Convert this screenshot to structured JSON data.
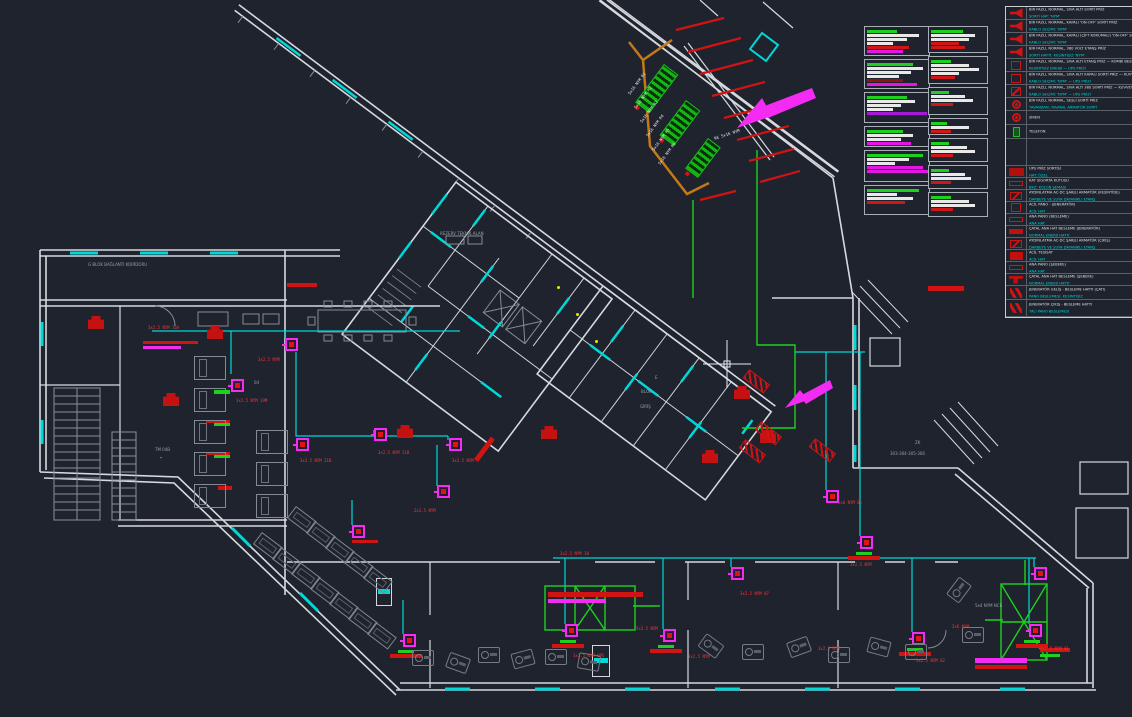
{
  "colors": {
    "background": "#1e232e",
    "wall": "#d6dade",
    "cyan": "#00d8d8",
    "green": "#1fd11f",
    "red": "#d01414",
    "magenta": "#f32bf3",
    "violet": "#a818d8",
    "orange": "#c27a18",
    "yellow": "#e8e800",
    "gray_furniture": "#80868f",
    "dim_text": "#99a0a9",
    "legend_cyan": "#00d8d8"
  },
  "labels": {
    "gray": [
      {
        "x": 88,
        "y": 262,
        "t": "G BLOK BAĞLANTI KORİDORU",
        "s": 8
      },
      {
        "x": 440,
        "y": 232,
        "t": "REZERV TEKNİK ALAN",
        "s": 5
      },
      {
        "x": 655,
        "y": 372,
        "t": "E",
        "s": 11
      },
      {
        "x": 641,
        "y": 386,
        "t": "BLOK",
        "s": 11
      },
      {
        "x": 640,
        "y": 401,
        "t": "GİRİŞ",
        "s": 11
      },
      {
        "x": 915,
        "y": 440,
        "t": "ZK",
        "s": 9
      },
      {
        "x": 890,
        "y": 451,
        "t": "303-304-305-306",
        "s": 9
      },
      {
        "x": 155,
        "y": 448,
        "t": "TM 04B",
        "s": 6
      },
      {
        "x": 160,
        "y": 456,
        "t": "←",
        "s": 7
      },
      {
        "x": 254,
        "y": 380,
        "t": "04",
        "s": 8
      },
      {
        "x": 975,
        "y": 604,
        "t": "5x4 NYM NCK",
        "s": 4
      }
    ],
    "circuit": [
      {
        "x": 148,
        "y": 317,
        "t": "3x2.5 NYM 16A"
      },
      {
        "x": 258,
        "y": 349,
        "t": "3x2.5 NYM"
      },
      {
        "x": 236,
        "y": 390,
        "t": "3x2.5 NYM 19M"
      },
      {
        "x": 300,
        "y": 450,
        "t": "3x2.5 NYM 21B"
      },
      {
        "x": 378,
        "y": 442,
        "t": "3x2.5 NYM 21B"
      },
      {
        "x": 452,
        "y": 450,
        "t": "3x2.5 NYM"
      },
      {
        "x": 414,
        "y": 500,
        "t": "2x2.5 NYM"
      },
      {
        "x": 560,
        "y": 543,
        "t": "3x2.5 NYM 18"
      },
      {
        "x": 573,
        "y": 645,
        "t": "3x2.5 NYM UPS"
      },
      {
        "x": 636,
        "y": 618,
        "t": "5x2.5 NYM"
      },
      {
        "x": 688,
        "y": 646,
        "t": "3x2.5 NYM"
      },
      {
        "x": 740,
        "y": 583,
        "t": "3x2.5 NYM 07"
      },
      {
        "x": 838,
        "y": 492,
        "t": "5x6 NYM 05"
      },
      {
        "x": 850,
        "y": 554,
        "t": "3x2.5 NYM"
      },
      {
        "x": 916,
        "y": 650,
        "t": "3x2.5 NYM 02"
      },
      {
        "x": 1040,
        "y": 638,
        "t": "3x2.5 NYM 01"
      },
      {
        "x": 952,
        "y": 616,
        "t": "2x6 NYM"
      },
      {
        "x": 818,
        "y": 638,
        "t": "3x2.5 NYM"
      }
    ],
    "risers": [
      {
        "x": 628,
        "y": 84,
        "t": "5x16 NYM R1",
        "rot": -53
      },
      {
        "x": 634,
        "y": 98,
        "t": "5x16 NYM R2",
        "rot": -53
      },
      {
        "x": 640,
        "y": 112,
        "t": "5x16 NYM R3",
        "rot": -53
      },
      {
        "x": 646,
        "y": 126,
        "t": "5x16 NYM R4",
        "rot": -53
      },
      {
        "x": 652,
        "y": 140,
        "t": "5x16 NYM R5",
        "rot": -53
      },
      {
        "x": 658,
        "y": 154,
        "t": "5x16 NYM R6",
        "rot": -53
      },
      {
        "x": 714,
        "y": 128,
        "t": "RE 5x16 NYM",
        "rot": -18
      }
    ]
  },
  "devices": {
    "sockets": [
      {
        "x": 285,
        "y": 338
      },
      {
        "x": 231,
        "y": 379
      },
      {
        "x": 296,
        "y": 438
      },
      {
        "x": 374,
        "y": 428
      },
      {
        "x": 449,
        "y": 438
      },
      {
        "x": 437,
        "y": 485
      },
      {
        "x": 352,
        "y": 525
      },
      {
        "x": 403,
        "y": 634
      },
      {
        "x": 565,
        "y": 624
      },
      {
        "x": 663,
        "y": 629
      },
      {
        "x": 731,
        "y": 567
      },
      {
        "x": 826,
        "y": 490
      },
      {
        "x": 860,
        "y": 536
      },
      {
        "x": 912,
        "y": 632
      },
      {
        "x": 1029,
        "y": 624
      },
      {
        "x": 1034,
        "y": 567
      }
    ],
    "bases": [
      {
        "x": 552,
        "y": 640
      },
      {
        "x": 650,
        "y": 645
      },
      {
        "x": 899,
        "y": 648
      },
      {
        "x": 1016,
        "y": 640
      },
      {
        "x": 390,
        "y": 650
      },
      {
        "x": 848,
        "y": 552
      }
    ],
    "cabinets": [
      {
        "x": 88,
        "y": 316
      },
      {
        "x": 207,
        "y": 326
      },
      {
        "x": 163,
        "y": 393
      },
      {
        "x": 397,
        "y": 425
      },
      {
        "x": 541,
        "y": 426
      },
      {
        "x": 734,
        "y": 386
      },
      {
        "x": 702,
        "y": 450
      },
      {
        "x": 760,
        "y": 430
      }
    ],
    "dampers": [
      {
        "x": 746,
        "y": 368,
        "rot": 37
      },
      {
        "x": 758,
        "y": 420,
        "rot": 37
      },
      {
        "x": 812,
        "y": 437,
        "rot": 37
      },
      {
        "x": 742,
        "y": 438,
        "rot": 37
      }
    ],
    "ghatch": [
      {
        "x": 664,
        "y": 64,
        "w": 16,
        "h": 46,
        "rot": 37
      },
      {
        "x": 686,
        "y": 100,
        "w": 16,
        "h": 42,
        "rot": 37
      },
      {
        "x": 708,
        "y": 138,
        "w": 14,
        "h": 36,
        "rot": 37
      }
    ],
    "strips": [
      {
        "x": 143,
        "y": 341,
        "w": 55,
        "h": 3,
        "bg": "#d01414"
      },
      {
        "x": 143,
        "y": 346,
        "w": 38,
        "h": 3,
        "bg": "#f32bf3"
      },
      {
        "x": 548,
        "y": 592,
        "w": 95,
        "h": 5,
        "bg": "#d01414"
      },
      {
        "x": 548,
        "y": 599,
        "w": 58,
        "h": 4,
        "bg": "#f32bf3"
      },
      {
        "x": 928,
        "y": 286,
        "w": 36,
        "h": 5,
        "bg": "#d01414"
      },
      {
        "x": 975,
        "y": 658,
        "w": 52,
        "h": 5,
        "bg": "#f32bf3"
      },
      {
        "x": 975,
        "y": 665,
        "w": 52,
        "h": 4,
        "bg": "#d01414"
      },
      {
        "x": 287,
        "y": 283,
        "w": 30,
        "h": 4,
        "bg": "#d01414"
      },
      {
        "x": 476,
        "y": 458,
        "w": 28,
        "h": 5,
        "bg": "#d01414",
        "rot": -53
      },
      {
        "x": 1040,
        "y": 648,
        "w": 30,
        "h": 4,
        "bg": "#d01414"
      },
      {
        "x": 1040,
        "y": 654,
        "w": 20,
        "h": 3,
        "bg": "#1fd11f"
      },
      {
        "x": 352,
        "y": 540,
        "w": 26,
        "h": 3,
        "bg": "#d01414"
      },
      {
        "x": 214,
        "y": 390,
        "w": 16,
        "h": 4,
        "bg": "#1fd11f"
      },
      {
        "x": 214,
        "y": 422,
        "w": 16,
        "h": 4,
        "bg": "#1fd11f"
      },
      {
        "x": 214,
        "y": 454,
        "w": 16,
        "h": 4,
        "bg": "#1fd11f"
      },
      {
        "x": 218,
        "y": 486,
        "w": 14,
        "h": 4,
        "bg": "#d01414"
      },
      {
        "x": 206,
        "y": 420,
        "w": 24,
        "h": 3,
        "bg": "#d01414"
      },
      {
        "x": 206,
        "y": 452,
        "w": 24,
        "h": 3,
        "bg": "#d01414"
      }
    ],
    "ydots": [
      {
        "x": 557,
        "y": 286
      },
      {
        "x": 576,
        "y": 313
      },
      {
        "x": 595,
        "y": 340
      }
    ],
    "doors": [
      {
        "x": 376,
        "y": 578,
        "w": 14,
        "h": 26
      },
      {
        "x": 592,
        "y": 645,
        "w": 16,
        "h": 30
      }
    ],
    "desks": [
      {
        "x": 296,
        "y": 506,
        "rot": 37
      },
      {
        "x": 315,
        "y": 521,
        "rot": 37
      },
      {
        "x": 334,
        "y": 536,
        "rot": 37
      },
      {
        "x": 353,
        "y": 551,
        "rot": 37
      },
      {
        "x": 372,
        "y": 566,
        "rot": 37
      },
      {
        "x": 262,
        "y": 532,
        "rot": 37
      },
      {
        "x": 281,
        "y": 547,
        "rot": 37
      },
      {
        "x": 300,
        "y": 562,
        "rot": 37
      },
      {
        "x": 319,
        "y": 577,
        "rot": 37
      },
      {
        "x": 338,
        "y": 592,
        "rot": 37
      },
      {
        "x": 357,
        "y": 607,
        "rot": 37
      },
      {
        "x": 376,
        "y": 622,
        "rot": 37
      }
    ],
    "beds": [
      {
        "x": 194,
        "y": 356
      },
      {
        "x": 194,
        "y": 388
      },
      {
        "x": 194,
        "y": 420
      },
      {
        "x": 194,
        "y": 452
      },
      {
        "x": 194,
        "y": 484
      },
      {
        "x": 256,
        "y": 430
      },
      {
        "x": 256,
        "y": 462
      },
      {
        "x": 256,
        "y": 494
      }
    ],
    "gyms": [
      {
        "x": 412,
        "y": 650
      },
      {
        "x": 447,
        "y": 655,
        "rot": 20
      },
      {
        "x": 478,
        "y": 647
      },
      {
        "x": 512,
        "y": 651,
        "rot": -15
      },
      {
        "x": 545,
        "y": 649
      },
      {
        "x": 578,
        "y": 654,
        "rot": 10
      },
      {
        "x": 700,
        "y": 638,
        "rot": 36
      },
      {
        "x": 742,
        "y": 644
      },
      {
        "x": 788,
        "y": 639,
        "rot": -20
      },
      {
        "x": 828,
        "y": 647
      },
      {
        "x": 868,
        "y": 639,
        "rot": 15
      },
      {
        "x": 905,
        "y": 644
      },
      {
        "x": 948,
        "y": 582,
        "rot": -53
      },
      {
        "x": 962,
        "y": 627
      }
    ]
  },
  "schedules": {
    "boxes": [
      {
        "x": 864,
        "y": 26,
        "w": 66,
        "h": 30,
        "bars": [
          {
            "bg": "#1fd11f",
            "w": 30
          },
          {
            "bg": "#e8e8e8",
            "w": 52
          },
          {
            "bg": "#e8e8e8",
            "w": 40
          },
          {
            "bg": "#e8e8e8",
            "w": 26
          },
          {
            "bg": "#cf1717",
            "w": 42
          },
          {
            "bg": "#e515e5",
            "w": 36
          }
        ]
      },
      {
        "x": 864,
        "y": 59,
        "w": 66,
        "h": 30,
        "bars": [
          {
            "bg": "#1fd11f",
            "w": 46
          },
          {
            "bg": "#e8e8e8",
            "w": 56
          },
          {
            "bg": "#e8e8e8",
            "w": 44
          },
          {
            "bg": "#e8e8e8",
            "w": 32
          },
          {
            "bg": "#8c1515",
            "w": 36
          },
          {
            "bg": "#e515e5",
            "w": 50
          }
        ]
      },
      {
        "x": 864,
        "y": 92,
        "w": 66,
        "h": 31,
        "bars": [
          {
            "bg": "#1fd11f",
            "w": 40
          },
          {
            "bg": "#e8e8e8",
            "w": 48
          },
          {
            "bg": "#e8e8e8",
            "w": 34
          },
          {
            "bg": "#e8e8e8",
            "w": 26
          },
          {
            "bg": "#a818d8",
            "w": 60
          }
        ]
      },
      {
        "x": 864,
        "y": 126,
        "w": 66,
        "h": 21,
        "bars": [
          {
            "bg": "#1fd11f",
            "w": 36
          },
          {
            "bg": "#e8e8e8",
            "w": 46
          },
          {
            "bg": "#e8e8e8",
            "w": 34
          },
          {
            "bg": "#e515e5",
            "w": 44
          }
        ]
      },
      {
        "x": 864,
        "y": 150,
        "w": 66,
        "h": 32,
        "bars": [
          {
            "bg": "#1fd11f",
            "w": 56
          },
          {
            "bg": "#e8e8e8",
            "w": 42
          },
          {
            "bg": "#e8e8e8",
            "w": 28
          },
          {
            "bg": "#e515e5",
            "w": 56
          },
          {
            "bg": "#e515e5",
            "w": 62
          }
        ]
      },
      {
        "x": 864,
        "y": 185,
        "w": 66,
        "h": 30,
        "bars": [
          {
            "bg": "#1fd11f",
            "w": 52
          },
          {
            "bg": "#e8e8e8",
            "w": 30
          },
          {
            "bg": "#e8e8e8",
            "w": 46
          },
          {
            "bg": "#cf1717",
            "w": 38
          }
        ]
      },
      {
        "x": 928,
        "y": 26,
        "w": 60,
        "h": 27,
        "bars": [
          {
            "bg": "#1fd11f",
            "w": 32
          },
          {
            "bg": "#e8e8e8",
            "w": 44
          },
          {
            "bg": "#e8e8e8",
            "w": 38
          },
          {
            "bg": "#cf1717",
            "w": 28
          },
          {
            "bg": "#cf1717",
            "w": 34
          }
        ]
      },
      {
        "x": 928,
        "y": 56,
        "w": 60,
        "h": 28,
        "bars": [
          {
            "bg": "#1fd11f",
            "w": 20
          },
          {
            "bg": "#e8e8e8",
            "w": 38
          },
          {
            "bg": "#e8e8e8",
            "w": 48
          },
          {
            "bg": "#e8e8e8",
            "w": 28
          },
          {
            "bg": "#cf1717",
            "w": 24
          }
        ]
      },
      {
        "x": 928,
        "y": 87,
        "w": 60,
        "h": 28,
        "bars": [
          {
            "bg": "#1fd11f",
            "w": 18
          },
          {
            "bg": "#e8e8e8",
            "w": 34
          },
          {
            "bg": "#e8e8e8",
            "w": 42
          },
          {
            "bg": "#cf1717",
            "w": 22
          }
        ]
      },
      {
        "x": 928,
        "y": 118,
        "w": 60,
        "h": 17,
        "bars": [
          {
            "bg": "#1fd11f",
            "w": 16
          },
          {
            "bg": "#e8e8e8",
            "w": 38
          },
          {
            "bg": "#cf1717",
            "w": 20
          }
        ]
      },
      {
        "x": 928,
        "y": 138,
        "w": 60,
        "h": 24,
        "bars": [
          {
            "bg": "#1fd11f",
            "w": 18
          },
          {
            "bg": "#e8e8e8",
            "w": 36
          },
          {
            "bg": "#e8e8e8",
            "w": 44
          },
          {
            "bg": "#cf1717",
            "w": 22
          }
        ]
      },
      {
        "x": 928,
        "y": 165,
        "w": 60,
        "h": 24,
        "bars": [
          {
            "bg": "#1fd11f",
            "w": 18
          },
          {
            "bg": "#e8e8e8",
            "w": 34
          },
          {
            "bg": "#e8e8e8",
            "w": 40
          },
          {
            "bg": "#cf1717",
            "w": 20
          }
        ]
      },
      {
        "x": 928,
        "y": 192,
        "w": 60,
        "h": 25,
        "bars": [
          {
            "bg": "#1fd11f",
            "w": 20
          },
          {
            "bg": "#e8e8e8",
            "w": 38
          },
          {
            "bg": "#e8e8e8",
            "w": 44
          },
          {
            "bg": "#cf1717",
            "w": 22
          }
        ]
      }
    ]
  },
  "legend": {
    "rows": [
      {
        "h": 12,
        "icon": "ic ic-horn",
        "t1": "BİR FAZLI, NORMAL, SIVA ALTI SORTİ PRİZ",
        "t2": "SORTİ HAT: 'NYM'"
      },
      {
        "h": 12,
        "icon": "ic ic-horn",
        "t1": "BİR FAZLI, NORMAL, KAPALI 'ON-OFF' SORTİ PRİZ",
        "t2": "KABLO SEÇİMİ: 'NYM'"
      },
      {
        "h": 12,
        "icon": "ic ic-horn",
        "t1": "BİR FAZLI, NORMAL, KAPALI (ÇİFT KORUMALI) 'ON-OFF' SORTİ PRİZ",
        "t2": "KABLO SEÇİMİ: 'NYM'"
      },
      {
        "h": 12,
        "icon": "ic ic-horn",
        "t1": "BİR FAZLI, NORMAL, 380 VOLT ETANŞ PRİZ",
        "t2": "SORTİ HATTI: KESİNTİSİZ 'NYM'"
      },
      {
        "h": 12,
        "icon": "ic ic-sq",
        "t1": "BİR FAZLI, NORMAL, SIVA ALTI ETANŞ PRİZ — KOMBİ BESLEME",
        "t2": "KESİNTİSİZ ENERJİ — UPS PRİZİ"
      },
      {
        "h": 12,
        "icon": "ic ic-sq",
        "t1": "BİR FAZLI, NORMAL, SIVA ALTI KAPALI SORTİ PRİZ — KUVVET BESLEME",
        "t2": "KABLO SEÇİMİ: 'NYM' — UPS PRİZİ"
      },
      {
        "h": 12,
        "icon": "ic ic-sqg",
        "t1": "BİR FAZLI, NORMAL, SIVA ALTI 380 SORTİ PRİZ — KUVVET BESLEME",
        "t2": "KABLO SEÇİMİ: 'NYM' — UPS PRİZİ"
      },
      {
        "h": 12,
        "icon": "ic ic-ring",
        "t1": "BİR FAZLI, NORMAL, SESLİ SORTİ PRİZ",
        "t2": "TAVANDAN, TAVANA, ARMATÜR SORTİ"
      },
      {
        "h": 13,
        "icon": "ic ic-ring",
        "t1": "SİREN",
        "t2": ""
      },
      {
        "h": 13,
        "icon": "ic ic-tel",
        "t1": "TELEFON",
        "t2": ""
      },
      {
        "h": 26,
        "icon": "",
        "t1": "",
        "t2": ""
      },
      {
        "h": 11,
        "icon": "ic ic-ups",
        "t1": "UPS PRİZ SORTİSİ",
        "t2": "HAT: ÖZEL"
      },
      {
        "h": 11,
        "icon": "ic ic-bar",
        "t1": "KAT SIGORTA KUTUSU",
        "t2": "BKZ: KOLON ŞEMASI"
      },
      {
        "h": 11,
        "icon": "ic ic-diag",
        "t1": "AYDINLATMA AC-DC ŞARJLI ARMATÜR (KESİNTİDE)",
        "t2": "DARBEYE VE SUYA DAYANIKLI ETANŞ"
      },
      {
        "h": 11,
        "icon": "ic ic-sq",
        "t1": "ACİL PANO - (JENERATÖR)",
        "t2": "ACİL HAT"
      },
      {
        "h": 11,
        "icon": "ic ic-bar",
        "t1": "ANA PANO (BESLEME)",
        "t2": "ANA HAT"
      },
      {
        "h": 11,
        "icon": "ic ic-barF",
        "t1": "ÇATAL ANA HAT BESLEME (JENERATÖR)",
        "t2": "NORMAL ENERJİ HATTI"
      },
      {
        "h": 11,
        "icon": "ic ic-diag",
        "t1": "AYDINLATMA AC-DC ŞARJLI ARMATÜR (ÇIKIŞ)",
        "t2": "DARBEYE VE SUYA DAYANIKLI ETANŞ"
      },
      {
        "h": 11,
        "icon": "ic ic-fill",
        "t1": "ACİL TESİSAT",
        "t2": "ACİL HAT"
      },
      {
        "h": 11,
        "icon": "ic ic-bar",
        "t1": "ANA PANO (ŞEBEKE)",
        "t2": "ANA HAT"
      },
      {
        "h": 11,
        "icon": "ic ic-tee",
        "t1": "ÇATAL ANA HAT BESLEME (ŞEBEKE)",
        "t2": "NORMAL ENERJİ HATTI"
      },
      {
        "h": 13,
        "icon": "ic ic-hh",
        "t1": "JENERATÖR GELİŞ - BESLEME HATTI (ÇATI)",
        "t2": "PANO BESLEMESİ, KESİNTİSİZ"
      },
      {
        "h": 16,
        "icon": "ic ic-hh",
        "t1": "JENERATÖR ÇIKIŞ - BESLEME HATTI",
        "t2": "TALİ PANO BESLEMESİ"
      }
    ]
  }
}
